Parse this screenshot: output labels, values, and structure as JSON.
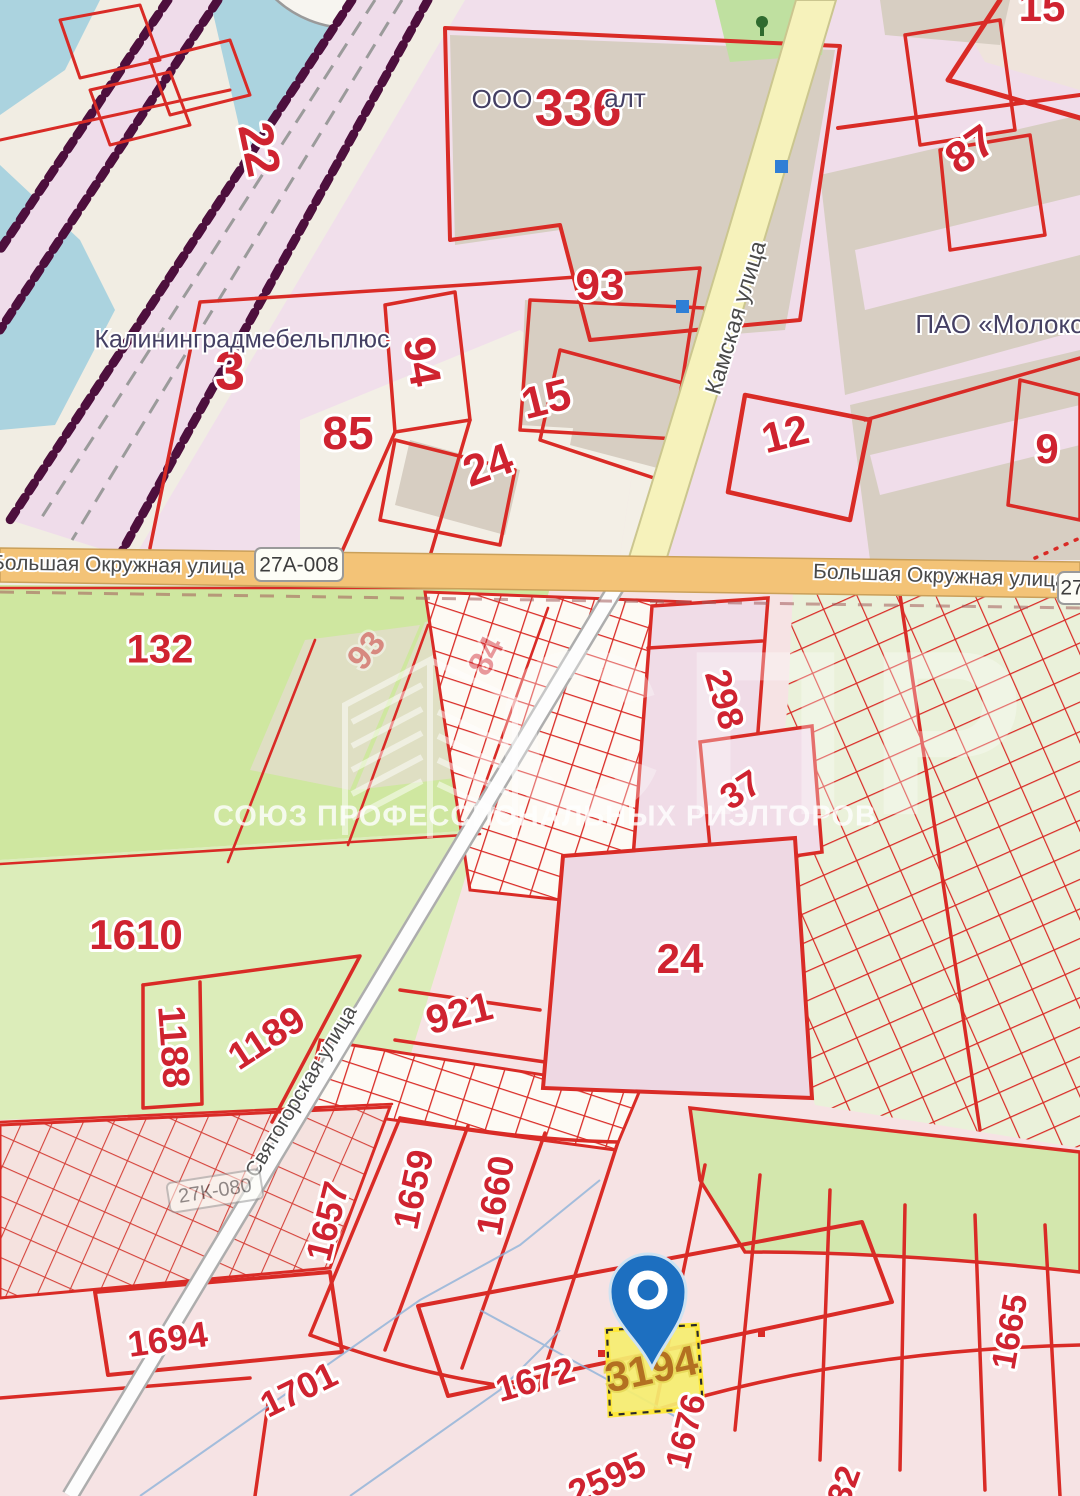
{
  "map": {
    "watermark": {
      "org_abbr": "СПР",
      "org_name": "СОЮЗ ПРОФЕССИОНАЛЬНЫХ РИЭЛТОРОВ"
    },
    "marker": {
      "plot_number": "3194"
    },
    "shields": {
      "okr_left": "27А-008",
      "okr_right": "27",
      "svyat": "27К-080"
    },
    "colors": {
      "parcel_line_red": "#d92b26",
      "label_red": "#cf2330",
      "pin_blue": "#1d6fc0",
      "highlight_yellow": "#f6ee71",
      "road_orange": "#f3c377",
      "road_yellow": "#f6f2bb",
      "water_blue": "#abd3df",
      "field_green": "#cfe7a0",
      "railway_maroon": "#4d0f3d"
    },
    "labels": [
      {
        "text": "22",
        "x": 256,
        "y": 150,
        "rot": 78,
        "fs": 48,
        "cls": "parcel",
        "name": "parcel-number-22"
      },
      {
        "text": "3",
        "x": 230,
        "y": 375,
        "rot": 0,
        "fs": 54,
        "cls": "parcel",
        "name": "parcel-number-3"
      },
      {
        "text": "94",
        "x": 419,
        "y": 362,
        "rot": 80,
        "fs": 44,
        "cls": "parcel",
        "name": "parcel-number-94"
      },
      {
        "text": "85",
        "x": 348,
        "y": 437,
        "rot": 0,
        "fs": 46,
        "cls": "parcel",
        "name": "parcel-number-85"
      },
      {
        "text": "336",
        "x": 578,
        "y": 112,
        "rot": 0,
        "fs": 52,
        "cls": "parcel",
        "name": "parcel-number-336"
      },
      {
        "text": "93",
        "x": 600,
        "y": 288,
        "rot": 0,
        "fs": 44,
        "cls": "parcel",
        "name": "parcel-number-93"
      },
      {
        "text": "15",
        "x": 547,
        "y": 402,
        "rot": -14,
        "fs": 44,
        "cls": "parcel",
        "name": "parcel-number-15"
      },
      {
        "text": "24",
        "x": 489,
        "y": 468,
        "rot": -20,
        "fs": 44,
        "cls": "parcel",
        "name": "parcel-number-24"
      },
      {
        "text": "12",
        "x": 786,
        "y": 437,
        "rot": -14,
        "fs": 42,
        "cls": "parcel",
        "name": "parcel-number-12"
      },
      {
        "text": "87",
        "x": 972,
        "y": 152,
        "rot": -35,
        "fs": 44,
        "cls": "parcel",
        "name": "parcel-number-87"
      },
      {
        "text": "9",
        "x": 1047,
        "y": 452,
        "rot": 0,
        "fs": 42,
        "cls": "parcel",
        "name": "parcel-number-9"
      },
      {
        "text": "15",
        "x": 1042,
        "y": 10,
        "rot": 0,
        "fs": 42,
        "cls": "parcel",
        "name": "parcel-number-15-top"
      },
      {
        "text": "132",
        "x": 160,
        "y": 652,
        "rot": 0,
        "fs": 40,
        "cls": "parcel",
        "name": "parcel-number-132"
      },
      {
        "text": "93",
        "x": 368,
        "y": 652,
        "rot": -50,
        "fs": 34,
        "cls": "parcel-faded",
        "name": "parcel-number-93-faded"
      },
      {
        "text": "84",
        "x": 488,
        "y": 657,
        "rot": -62,
        "fs": 34,
        "cls": "parcel-faded",
        "name": "parcel-number-84-faded"
      },
      {
        "text": "298",
        "x": 722,
        "y": 700,
        "rot": 74,
        "fs": 36,
        "cls": "parcel",
        "name": "parcel-number-298"
      },
      {
        "text": "37",
        "x": 742,
        "y": 792,
        "rot": -33,
        "fs": 36,
        "cls": "parcel",
        "name": "parcel-number-37"
      },
      {
        "text": "24",
        "x": 680,
        "y": 962,
        "rot": 0,
        "fs": 42,
        "cls": "parcel",
        "name": "parcel-number-24-big"
      },
      {
        "text": "921",
        "x": 460,
        "y": 1016,
        "rot": -14,
        "fs": 40,
        "cls": "parcel",
        "name": "parcel-number-921"
      },
      {
        "text": "1610",
        "x": 136,
        "y": 938,
        "rot": 0,
        "fs": 42,
        "cls": "parcel",
        "name": "parcel-number-1610"
      },
      {
        "text": "1188",
        "x": 171,
        "y": 1047,
        "rot": 86,
        "fs": 38,
        "cls": "parcel",
        "name": "parcel-number-1188"
      },
      {
        "text": "1189",
        "x": 268,
        "y": 1040,
        "rot": -33,
        "fs": 38,
        "cls": "parcel",
        "name": "parcel-number-1189"
      },
      {
        "text": "1657",
        "x": 330,
        "y": 1222,
        "rot": -76,
        "fs": 36,
        "cls": "parcel",
        "name": "parcel-number-1657"
      },
      {
        "text": "1659",
        "x": 416,
        "y": 1190,
        "rot": -78,
        "fs": 36,
        "cls": "parcel",
        "name": "parcel-number-1659"
      },
      {
        "text": "1660",
        "x": 498,
        "y": 1196,
        "rot": -80,
        "fs": 36,
        "cls": "parcel",
        "name": "parcel-number-1660"
      },
      {
        "text": "1694",
        "x": 168,
        "y": 1342,
        "rot": -8,
        "fs": 36,
        "cls": "parcel",
        "name": "parcel-number-1694"
      },
      {
        "text": "1701",
        "x": 300,
        "y": 1392,
        "rot": -26,
        "fs": 36,
        "cls": "parcel",
        "name": "parcel-number-1701"
      },
      {
        "text": "2595",
        "x": 608,
        "y": 1481,
        "rot": -24,
        "fs": 36,
        "cls": "parcel",
        "name": "parcel-number-2595"
      },
      {
        "text": "1672",
        "x": 536,
        "y": 1382,
        "rot": -16,
        "fs": 36,
        "cls": "parcel",
        "name": "parcel-number-1672"
      },
      {
        "text": "1676",
        "x": 688,
        "y": 1432,
        "rot": -76,
        "fs": 34,
        "cls": "parcel",
        "name": "parcel-number-1676"
      },
      {
        "text": "1665",
        "x": 1012,
        "y": 1332,
        "rot": -80,
        "fs": 34,
        "cls": "parcel",
        "name": "parcel-number-1665"
      },
      {
        "text": "32",
        "x": 846,
        "y": 1486,
        "rot": -70,
        "fs": 34,
        "cls": "parcel",
        "name": "parcel-number-32"
      },
      {
        "text": "3194",
        "x": 652,
        "y": 1372,
        "rot": -12,
        "fs": 42,
        "cls": "parcel-highlight",
        "name": "parcel-number-3194"
      },
      {
        "text": "Калининградмебельплюс",
        "x": 242,
        "y": 341,
        "rot": 0,
        "fs": 25,
        "cls": "poi",
        "name": "poi-label-kaliningradmebelplus"
      },
      {
        "text": "ООО",
        "x": 502,
        "y": 101,
        "rot": 0,
        "fs": 26,
        "cls": "poi",
        "name": "poi-label-ooo"
      },
      {
        "text": "алт",
        "x": 625,
        "y": 100,
        "rot": 0,
        "fs": 26,
        "cls": "poi",
        "name": "poi-label-alt"
      },
      {
        "text": "ПАО «Молоко",
        "x": 1000,
        "y": 326,
        "rot": 0,
        "fs": 26,
        "cls": "poi",
        "name": "poi-label-pao-moloko"
      },
      {
        "text": "Камская улица",
        "x": 737,
        "y": 318,
        "rot": -73,
        "fs": 23,
        "cls": "street",
        "name": "street-label-kamskaya"
      },
      {
        "text": "Большая Окружная улица",
        "x": 118,
        "y": 566,
        "rot": 1,
        "fs": 21,
        "cls": "street",
        "name": "street-label-okruzhnaya-left"
      },
      {
        "text": "Большая Окружная улица",
        "x": 940,
        "y": 577,
        "rot": 2,
        "fs": 21,
        "cls": "street",
        "name": "street-label-okruzhnaya-right"
      },
      {
        "text": "Святогорская улица",
        "x": 302,
        "y": 1092,
        "rot": -59,
        "fs": 21,
        "cls": "street",
        "name": "street-label-svyatogorskaya"
      }
    ]
  }
}
